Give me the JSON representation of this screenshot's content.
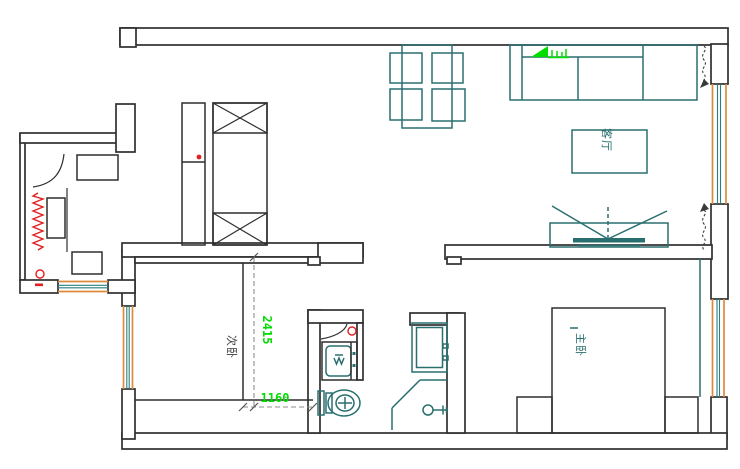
{
  "plan": {
    "rooms": {
      "living_room": {
        "label": "客厅"
      },
      "second_bedroom": {
        "label": "次卧"
      },
      "master_bedroom": {
        "label": "主卧"
      }
    },
    "dimensions": {
      "vertical_value": "2415",
      "horizontal_value": "1160"
    },
    "symbols": {
      "radiator": "red-coil",
      "gas_valve_kitchen": "red-circle",
      "water_valve_closet": "red-circle",
      "wardrobe": "x-crossed-cabinet",
      "washing_machine": "drum-box",
      "toilet": "tank-and-bowl",
      "shower": "sprayer-head",
      "tv": "screen-with-viewing-angle",
      "curtain": "dashed-squiggle",
      "plant": "green-plant"
    },
    "colors": {
      "wall": "#2f2f2f",
      "furniture": "#2a6f6f",
      "window_frame": "#dd8a3d",
      "glass": "#2a7f7f",
      "dimension_text": "#00dd00",
      "alert": "#e02020",
      "dashed_line": "#8c8c8c",
      "background": "#ffffff"
    }
  }
}
